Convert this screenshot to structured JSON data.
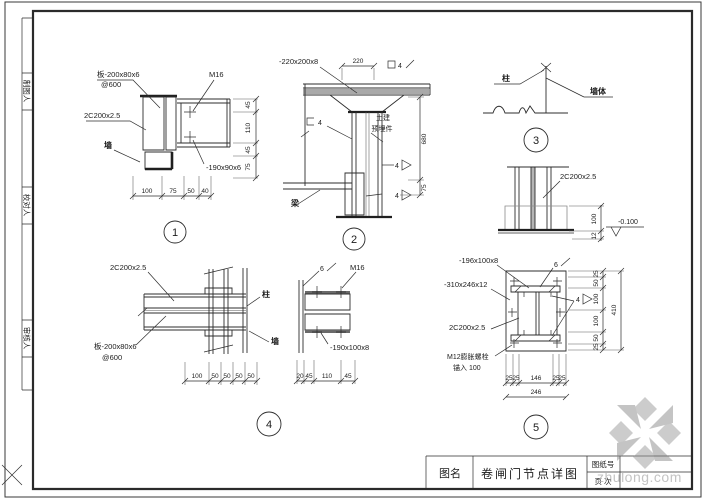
{
  "frame": {
    "margin_labels": [
      "制图人",
      "校对人",
      "审核人"
    ]
  },
  "title_block": {
    "name_label": "图名",
    "drawing_title": "卷闸门节点详图",
    "sheet_label": "图纸号",
    "page_label": "页 次"
  },
  "watermark": {
    "brand": "zhulong.com"
  },
  "colors": {
    "line": "#2d2d2d",
    "watermark_gray": "#9a9a9a"
  },
  "d1": {
    "no": "1",
    "plate": "板-200x80x6",
    "spacing": "@600",
    "bolt": "M16",
    "channel": "2C200x2.5",
    "plate2": "-190x90x6",
    "member": "墙",
    "dims_right": [
      "45",
      "110",
      "45",
      "75"
    ],
    "dims_bottom": [
      "100",
      "75",
      "50",
      "40"
    ]
  },
  "d2": {
    "no": "2",
    "plate": "-220x200x8",
    "dim_top": "220",
    "weld_box_num": "4",
    "weld_u_num": "4",
    "weld_fillet": "4",
    "note_line1": "土建",
    "note_line2": "预埋件",
    "beam": "梁",
    "dim_height": "680",
    "dim_small": "75"
  },
  "d3": {
    "no": "3",
    "label_left": "柱",
    "label_right": "墙体"
  },
  "base": {
    "channel": "2C200x2.5",
    "dim_a": "100",
    "dim_b": "12",
    "level": "-0.100"
  },
  "d4": {
    "no": "4",
    "channel": "2C200x2.5",
    "plate": "板-200x80x6",
    "spacing": "@600",
    "label_top": "柱",
    "label_bottom": "墙",
    "dims_bottom": [
      "100",
      "50",
      "50",
      "50",
      "50"
    ]
  },
  "d4s": {
    "weld": "6",
    "bolt": "M16",
    "plate": "-190x100x8",
    "dims_bottom": [
      "20",
      "45",
      "110",
      "45"
    ]
  },
  "d5": {
    "no": "5",
    "plate_top": "-196x100x8",
    "weld_top": "6",
    "plate_side": "-310x246x12",
    "weld_side": "4",
    "channel": "2C200x2.5",
    "anchor_line1": "M12膨胀螺栓",
    "anchor_line2": "锚入 100",
    "dims_right": [
      "25",
      "50",
      "100",
      "100",
      "50",
      "25"
    ],
    "dim_right_total": "410",
    "dims_bottom": [
      "25",
      "25",
      "146",
      "25",
      "25"
    ],
    "dim_bottom_total": "246"
  }
}
